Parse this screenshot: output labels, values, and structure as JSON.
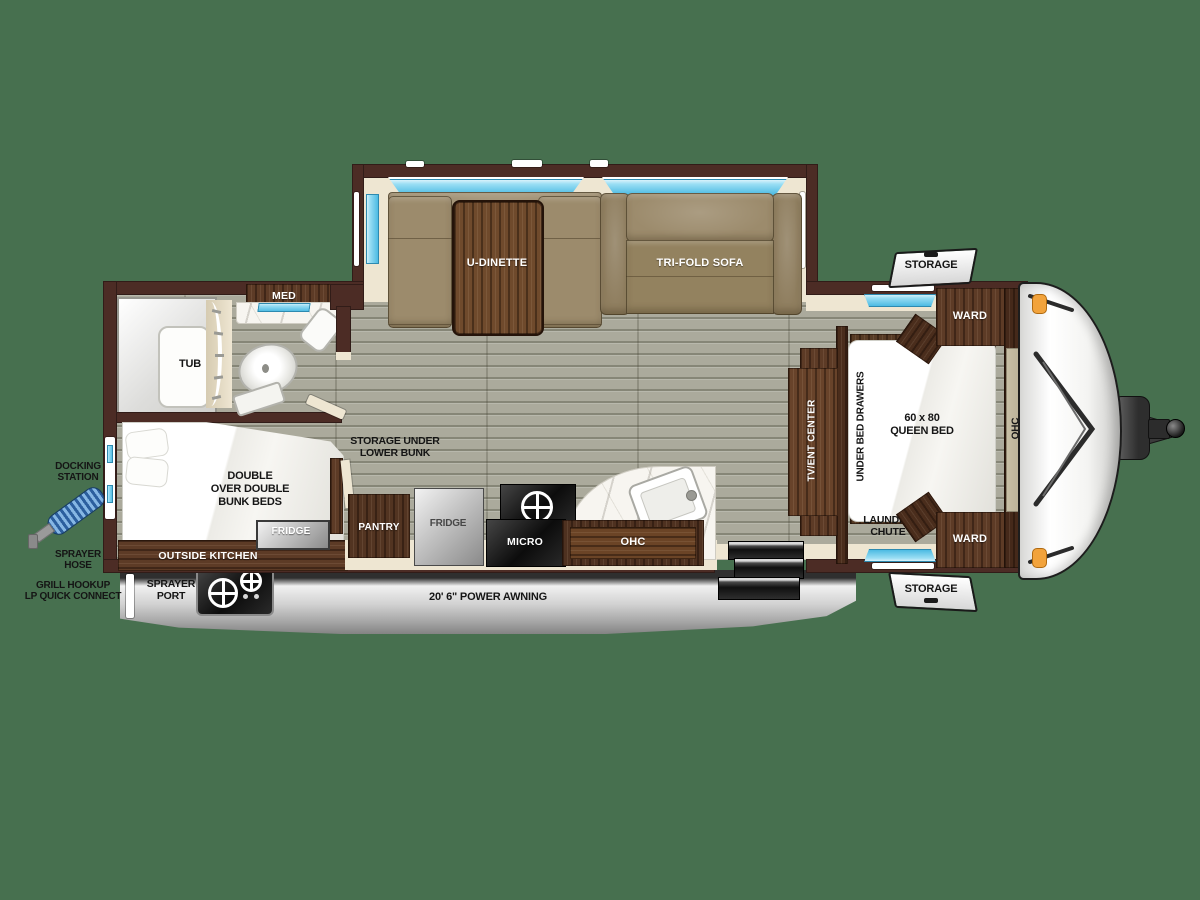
{
  "scene": {
    "bg_color": "#47704f",
    "accent_window_blue": "#49b9e2",
    "wall_brown": "#4c2c25",
    "marker_light_orange": "#f2a33c"
  },
  "slide_out": {
    "dinette_label": "U-DINETTE",
    "sofa_label": "TRI-FOLD SOFA"
  },
  "bathroom": {
    "med_label": "MED",
    "tub_label": "TUB"
  },
  "hall": {
    "storage_under_label": "STORAGE UNDER\nLOWER BUNK"
  },
  "bunk_room": {
    "bunks_label": "DOUBLE\nOVER DOUBLE\nBUNK BEDS",
    "outside_kitchen_label": "OUTSIDE KITCHEN",
    "outside_fridge_label": "FRIDGE"
  },
  "kitchen": {
    "pantry_label": "PANTRY",
    "fridge_label": "FRIDGE",
    "micro_label": "MICRO",
    "ohc_label": "OHC"
  },
  "bedroom": {
    "tv_label": "TV/ENT CENTER",
    "under_bed_label": "UNDER BED DRAWERS",
    "queen_label": "60 x 80\nQUEEN BED",
    "ohc_label": "OHC",
    "ward_top_label": "WARD",
    "ward_bottom_label": "WARD",
    "laundry_label": "LAUNDRY\nCHUTE"
  },
  "exterior": {
    "storage_top_label": "STORAGE",
    "storage_bottom_label": "STORAGE",
    "docking_label": "DOCKING\nSTATION",
    "sprayer_hose_label": "SPRAYER\nHOSE",
    "grill_label": "GRILL HOOKUP\nLP QUICK CONNECT",
    "sprayer_port_label": "SPRAYER\nPORT",
    "awning_label": "20' 6\" POWER AWNING"
  }
}
